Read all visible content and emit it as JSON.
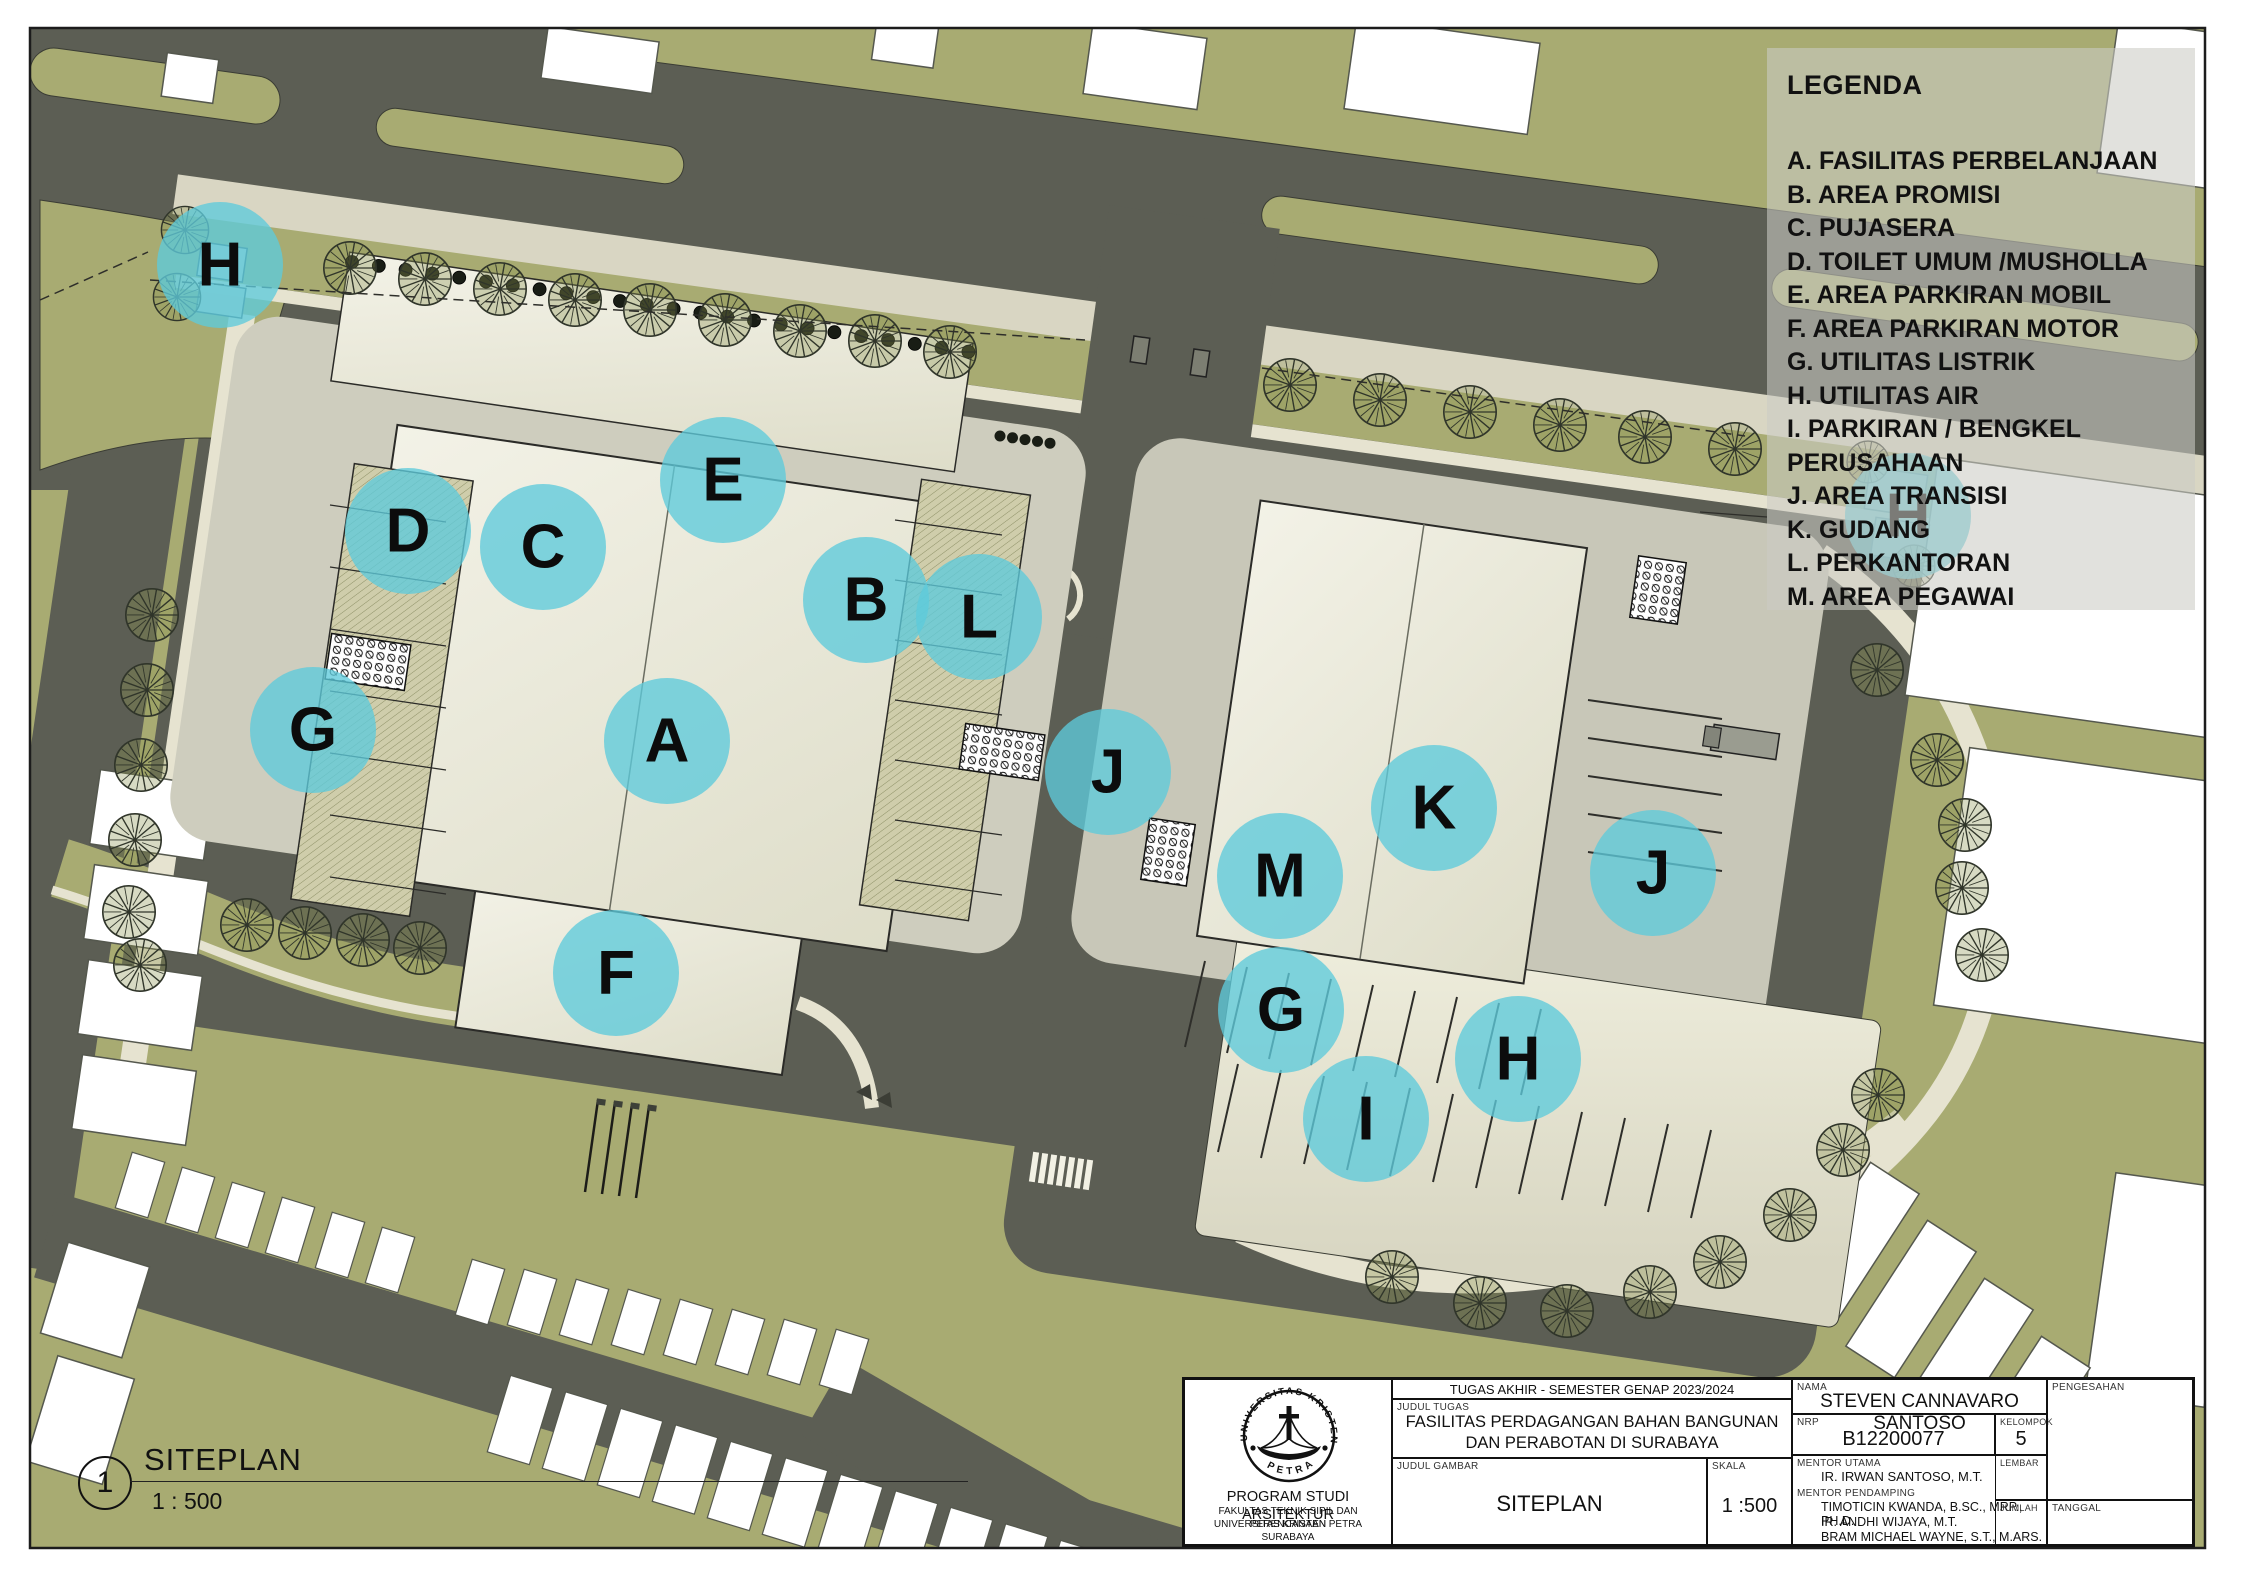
{
  "colors": {
    "olive": "#a8ab72",
    "road": "#5c5e54",
    "sidewalk": "#d9d6c3",
    "curb": "#e6e3d0",
    "plaza_left": "#cecdbe",
    "plaza_right": "#c8c7b8",
    "building_light": "#f3f2e7",
    "building_dark": "#deddc9",
    "marker_teal": "#5ecbdb",
    "white_lot": "#ffffff",
    "outline": "#2b2b28",
    "legend_bg": "rgba(204,204,197,0.58)"
  },
  "legend": {
    "title": "LEGENDA",
    "items": [
      "A. FASILITAS PERBELANJAAN",
      "B. AREA PROMISI",
      "C. PUJASERA",
      "D. TOILET UMUM /MUSHOLLA",
      "E. AREA PARKIRAN MOBIL",
      "F. AREA PARKIRAN MOTOR",
      "G. UTILITAS LISTRIK",
      "H. UTILITAS AIR",
      "I. PARKIRAN / BENGKEL PERUSAHAAN",
      "J. AREA TRANSISI",
      "K. GUDANG",
      "L. PERKANTORAN",
      "M. AREA PEGAWAI"
    ]
  },
  "markers": [
    {
      "letter": "H",
      "x": 220,
      "y": 265
    },
    {
      "letter": "D",
      "x": 408,
      "y": 531
    },
    {
      "letter": "C",
      "x": 543,
      "y": 547
    },
    {
      "letter": "E",
      "x": 723,
      "y": 480
    },
    {
      "letter": "B",
      "x": 866,
      "y": 600
    },
    {
      "letter": "L",
      "x": 979,
      "y": 617
    },
    {
      "letter": "G",
      "x": 313,
      "y": 730
    },
    {
      "letter": "A",
      "x": 667,
      "y": 741
    },
    {
      "letter": "J",
      "x": 1108,
      "y": 772
    },
    {
      "letter": "K",
      "x": 1434,
      "y": 808
    },
    {
      "letter": "M",
      "x": 1280,
      "y": 876
    },
    {
      "letter": "J",
      "x": 1653,
      "y": 873
    },
    {
      "letter": "F",
      "x": 616,
      "y": 973
    },
    {
      "letter": "G",
      "x": 1281,
      "y": 1010
    },
    {
      "letter": "H",
      "x": 1518,
      "y": 1059
    },
    {
      "letter": "I",
      "x": 1366,
      "y": 1119
    },
    {
      "letter": "H",
      "x": 1908,
      "y": 516
    }
  ],
  "drawing_label": {
    "number": "1",
    "title": "SITEPLAN",
    "scale": "1 : 500"
  },
  "title_block": {
    "header": "TUGAS AKHIR - SEMESTER GENAP 2023/2024",
    "judul_tugas_label": "JUDUL TUGAS",
    "judul_tugas_line1": "FASILITAS PERDAGANGAN BAHAN BANGUNAN",
    "judul_tugas_line2": "DAN PERABOTAN DI SURABAYA",
    "judul_gambar_label": "JUDUL GAMBAR",
    "judul_gambar": "SITEPLAN",
    "skala_label": "SKALA",
    "skala": "1 :500",
    "nama_label": "NAMA",
    "nama": "STEVEN CANNAVARO SANTOSO",
    "nrp_label": "NRP",
    "nrp": "B12200077",
    "kelompok_label": "KELOMPOK",
    "kelompok": "5",
    "lembar_label": "LEMBAR",
    "jumlah_label": "JUMLAH",
    "pengesahan_label": "PENGESAHAN",
    "tanggal_label": "TANGGAL",
    "mentor_utama_label": "MENTOR UTAMA",
    "mentor_utama": "IR. IRWAN SANTOSO, M.T.",
    "mentor_pendamping_label": "MENTOR PENDAMPING",
    "mentor_pendamping": [
      "TIMOTICIN KWANDA, B.SC., MRP., PH.D.",
      "IR. ANDHI WIJAYA, M.T.",
      "BRAM MICHAEL WAYNE, S.T., M.ARS."
    ],
    "institution": {
      "line1": "PROGRAM STUDI ARSITEKTUR",
      "line2": "FAKULTAS TEKNIK SIPIL DAN PERENCANAAN",
      "line3": "UNIVERSITAS KRISTEN PETRA",
      "line4": "SURABAYA"
    },
    "logo_top": "UNIVERSITAS KRISTEN",
    "logo_bottom": "PETRA"
  }
}
